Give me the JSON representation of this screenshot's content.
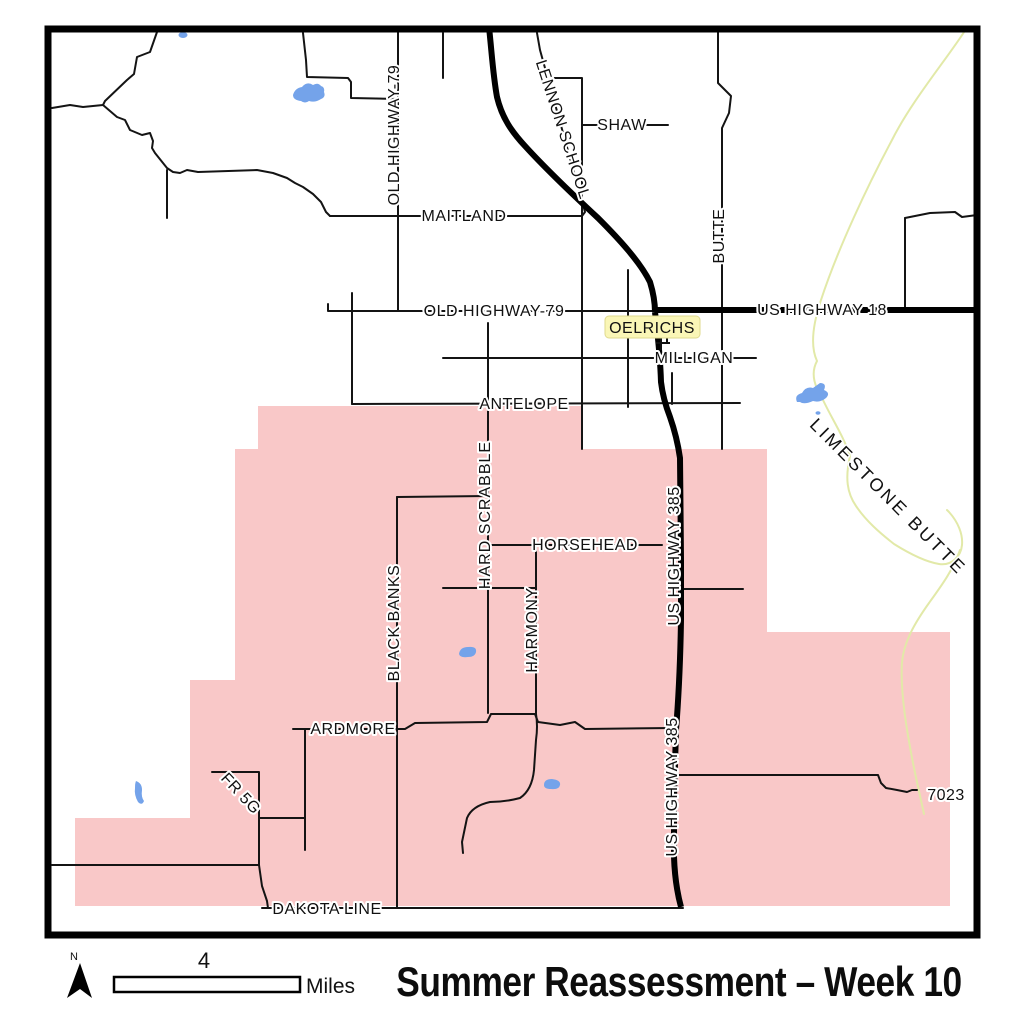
{
  "title": {
    "text": "Summer Reassessment – Week 10"
  },
  "scale_bar": {
    "value": "4",
    "unit": "Miles"
  },
  "north_arrow": {
    "label": "N"
  },
  "town_label": {
    "text": "OELRICHS"
  },
  "road_labels": [
    {
      "text": "OLD HIGHWAY-79"
    },
    {
      "text": "LENNON SCHOOL"
    },
    {
      "text": "SHAW"
    },
    {
      "text": "MAITLAND"
    },
    {
      "text": "BUTTE"
    },
    {
      "text": "OLD HIGHWAY-79"
    },
    {
      "text": "US HIGHWAY 18"
    },
    {
      "text": "MILLIGAN"
    },
    {
      "text": "ANTELOPE"
    },
    {
      "text": "HARD SCRABBLE"
    },
    {
      "text": "HORSEHEAD"
    },
    {
      "text": "US HIGHWAY 385"
    },
    {
      "text": "BLACK BANKS"
    },
    {
      "text": "HARMONY"
    },
    {
      "text": "ARDMORE"
    },
    {
      "text": "US HIGHWAY 385"
    },
    {
      "text": "FR 5G"
    },
    {
      "text": "7023"
    },
    {
      "text": "DAKOTA LINE"
    },
    {
      "text": "LIMESTONE BUTTE"
    }
  ],
  "colors": {
    "assessment_area": "#F9C8C8",
    "water": "#74A3EA",
    "stream": "#E2E9A8",
    "road": "#141414",
    "highway": "#000000",
    "town_highlight_bg": "#FAF6B6",
    "town_highlight_border": "#DFD98E",
    "frame": "#000000",
    "label_halo": "#FFFFFF"
  }
}
